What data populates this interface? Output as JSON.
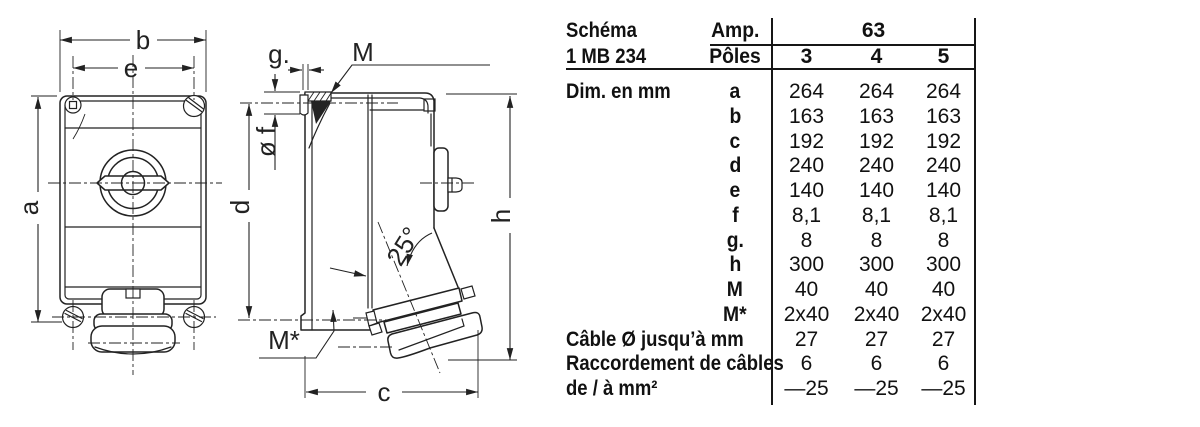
{
  "drawing": {
    "front_view": {
      "width_outer": "b",
      "width_inner": "e",
      "height": "a"
    },
    "side_view": {
      "flange_thickness": "g.",
      "top_screw": "M",
      "hole_diameter": "ø f",
      "hole_spacing": "d",
      "total_height": "h",
      "socket_angle": "25°",
      "bottom_screw": "M*",
      "depth": "c"
    }
  },
  "table": {
    "schema_label": "Schéma",
    "schema_value": "1 MB 234",
    "amp_label": "Amp.",
    "amp_value": "63",
    "poles_label": "Pôles",
    "poles": [
      "3",
      "4",
      "5"
    ],
    "dim_label": "Dim. en mm",
    "dim_rows": [
      {
        "key": "a",
        "values": [
          "264",
          "264",
          "264"
        ]
      },
      {
        "key": "b",
        "values": [
          "163",
          "163",
          "163"
        ]
      },
      {
        "key": "c",
        "values": [
          "192",
          "192",
          "192"
        ]
      },
      {
        "key": "d",
        "values": [
          "240",
          "240",
          "240"
        ]
      },
      {
        "key": "e",
        "values": [
          "140",
          "140",
          "140"
        ]
      },
      {
        "key": "f",
        "values": [
          "8,1",
          "8,1",
          "8,1"
        ]
      },
      {
        "key": "g.",
        "values": [
          "8",
          "8",
          "8"
        ]
      },
      {
        "key": "h",
        "values": [
          "300",
          "300",
          "300"
        ]
      },
      {
        "key": "M",
        "values": [
          "40",
          "40",
          "40"
        ]
      },
      {
        "key": "M*",
        "values": [
          "2x40",
          "2x40",
          "2x40"
        ]
      }
    ],
    "extra_rows": [
      {
        "label": "Câble Ø jusqu’à mm",
        "values": [
          "27",
          "27",
          "27"
        ]
      },
      {
        "label": "Raccordement de câbles",
        "values": [
          "6",
          "6",
          "6"
        ]
      },
      {
        "label": "de / à mm²",
        "values": [
          "—25",
          "—25",
          "—25"
        ]
      }
    ]
  }
}
